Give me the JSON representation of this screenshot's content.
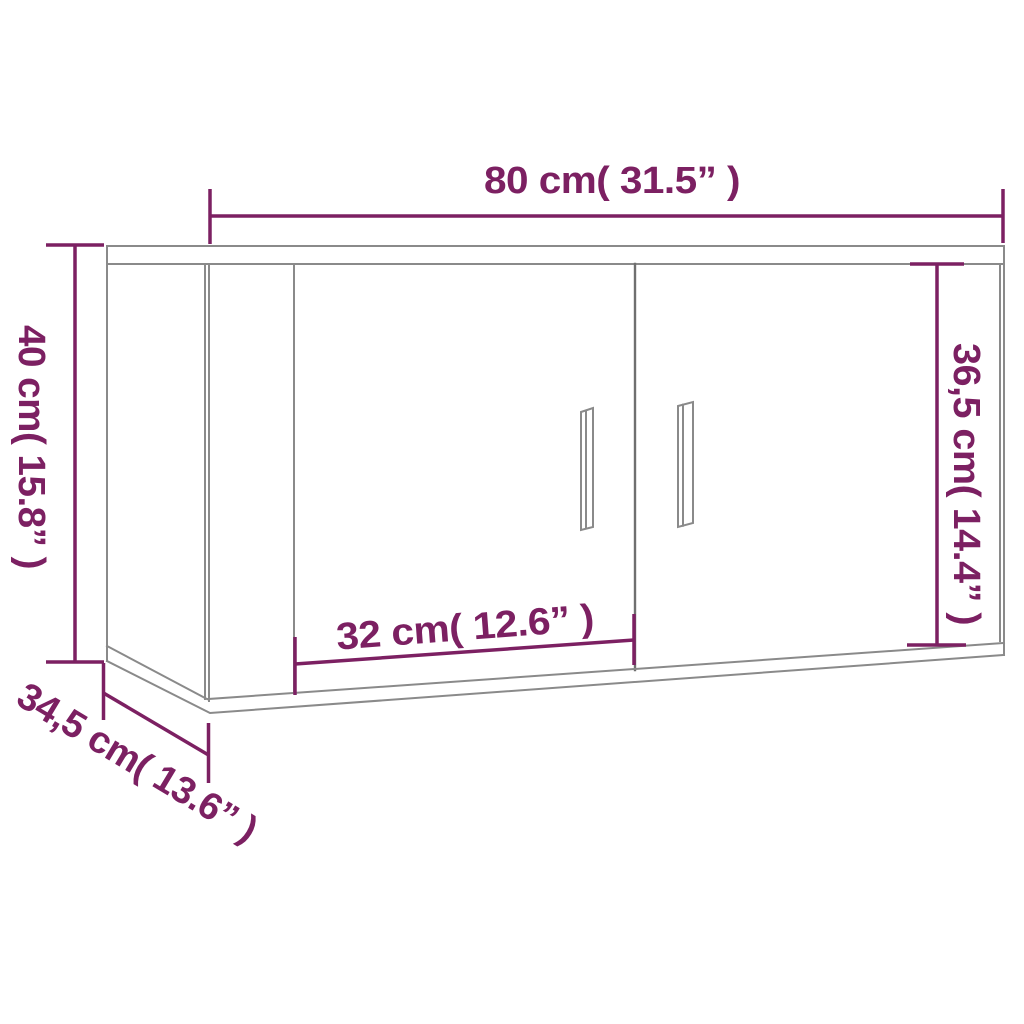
{
  "diagram": {
    "subject": "wall cabinet with two doors, front-left perspective line drawing",
    "style": "product dimension diagram"
  },
  "dimensions": {
    "width": {
      "cm": "80",
      "inches": "31.5",
      "label": "80 cm( 31.5” )"
    },
    "height": {
      "cm": "40",
      "inches": "15.8",
      "label": "40 cm( 15.8” )"
    },
    "inner_height": {
      "cm": "36,5",
      "inches": "14.4",
      "label": "36,5 cm( 14.4” )"
    },
    "door_width": {
      "cm": "32",
      "inches": "12.6",
      "label": "32 cm( 12.6” )"
    },
    "depth": {
      "cm": "34,5",
      "inches": "13.6",
      "label": "34,5 cm( 13.6” )"
    }
  },
  "colors": {
    "dimension": "#7c2062",
    "outline": "#8a8a8a",
    "outline_dark": "#6f6f6f",
    "background": "#ffffff"
  }
}
